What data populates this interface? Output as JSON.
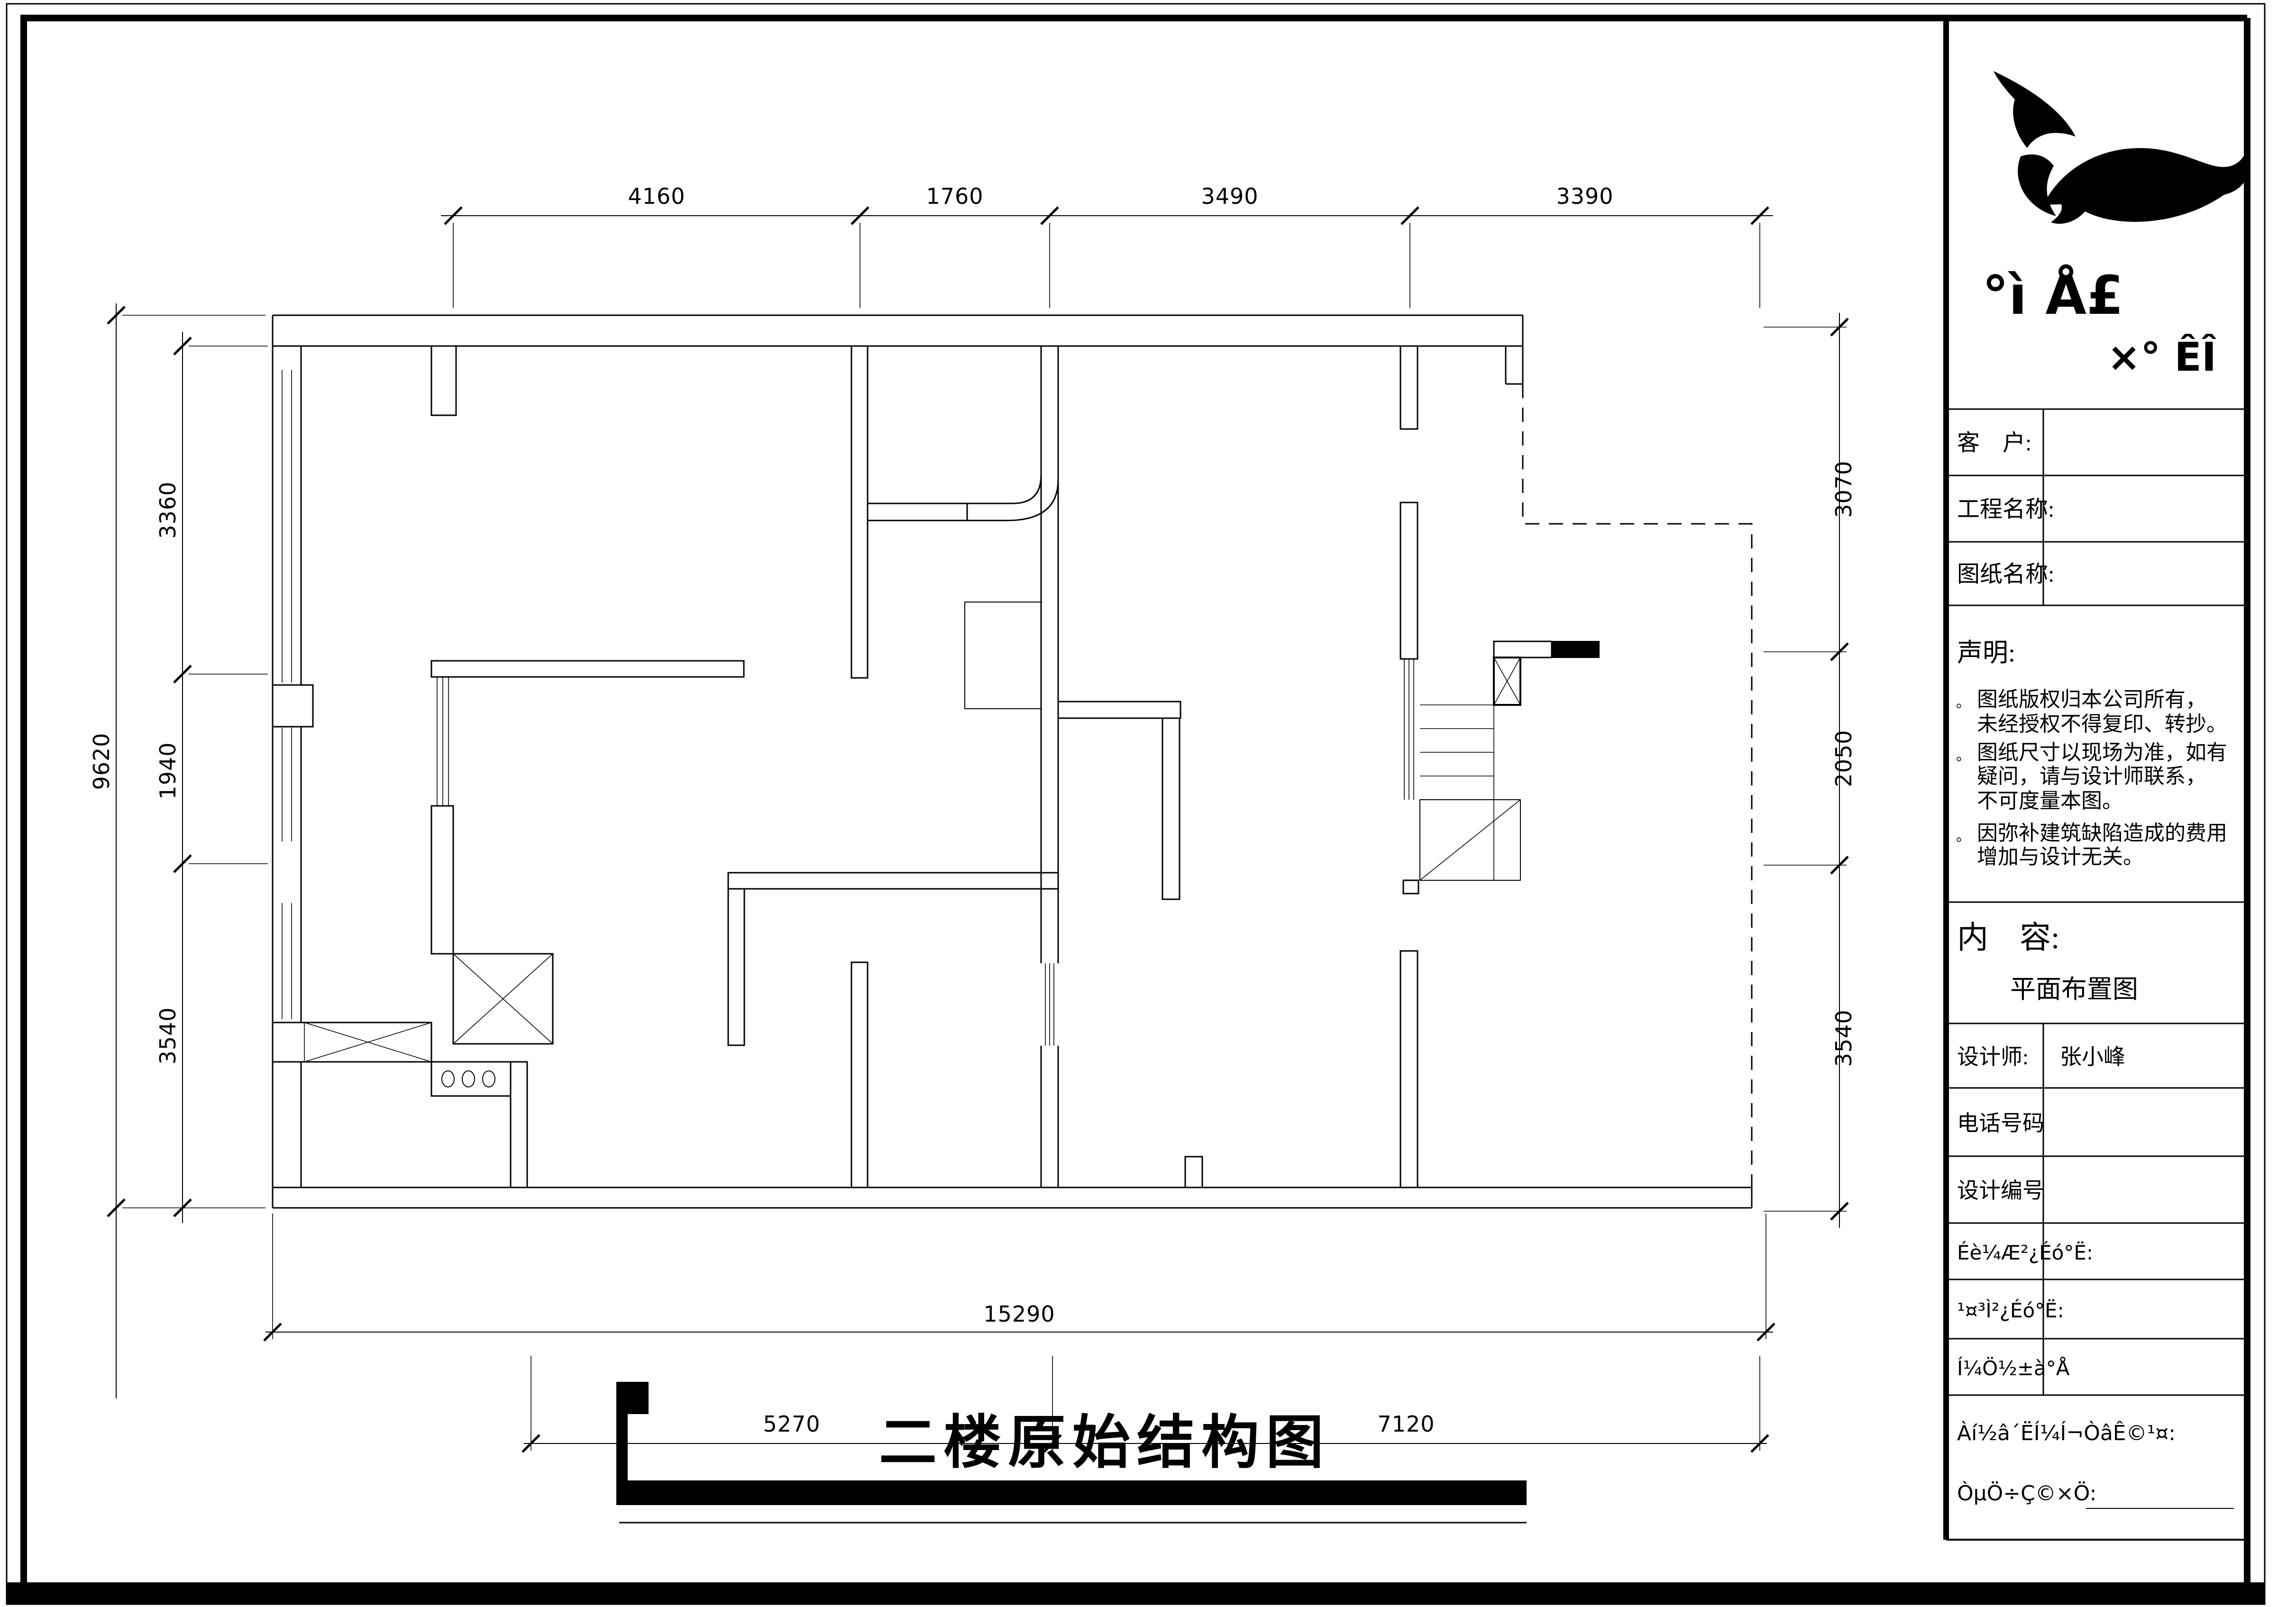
{
  "plan_title": "二楼原始结构图",
  "dims": {
    "top": [
      "4160",
      "1760",
      "3490",
      "3390"
    ],
    "left_outer": "9620",
    "left": [
      "3360",
      "1940",
      "3540"
    ],
    "right": [
      "3070",
      "2050",
      "3540"
    ],
    "bottom_outer": "15290",
    "bottom": [
      "5270",
      "7120"
    ]
  },
  "title_block": {
    "logo": {
      "line1": "°ì Å£",
      "line2": "×° ÊÎ"
    },
    "customer_label": "客　户:",
    "project_label": "工程名称:",
    "drawing_label": "图纸名称:",
    "statement_heading": "声明:",
    "statement_bullet": "。",
    "statement_lines": [
      "图纸版权归本公司所有，",
      "未经授权不得复印、转抄。",
      "图纸尺寸以现场为准，如有",
      "疑问，请与设计师联系，",
      "不可度量本图。",
      "因弥补建筑缺陷造成的费用",
      "增加与设计无关。"
    ],
    "content_heading": "内　容:",
    "content_value": "平面布置图",
    "designer_label": "设计师:",
    "designer_value": "张小峰",
    "phone_label": "电话号码",
    "design_no_label": "设计编号",
    "review1_label": "Éè¼Æ²¿Éó°Ë:",
    "review2_label": "¹¤³Ì²¿Éó°Ë:",
    "sheet_no_label": "Í¼Ö½±à°Å",
    "agree_label": "Àí½â´ËÍ¼Í¬ÒâÊ©¹¤:",
    "sign_label": "ÒµÖ÷Ç©×Ö:"
  }
}
